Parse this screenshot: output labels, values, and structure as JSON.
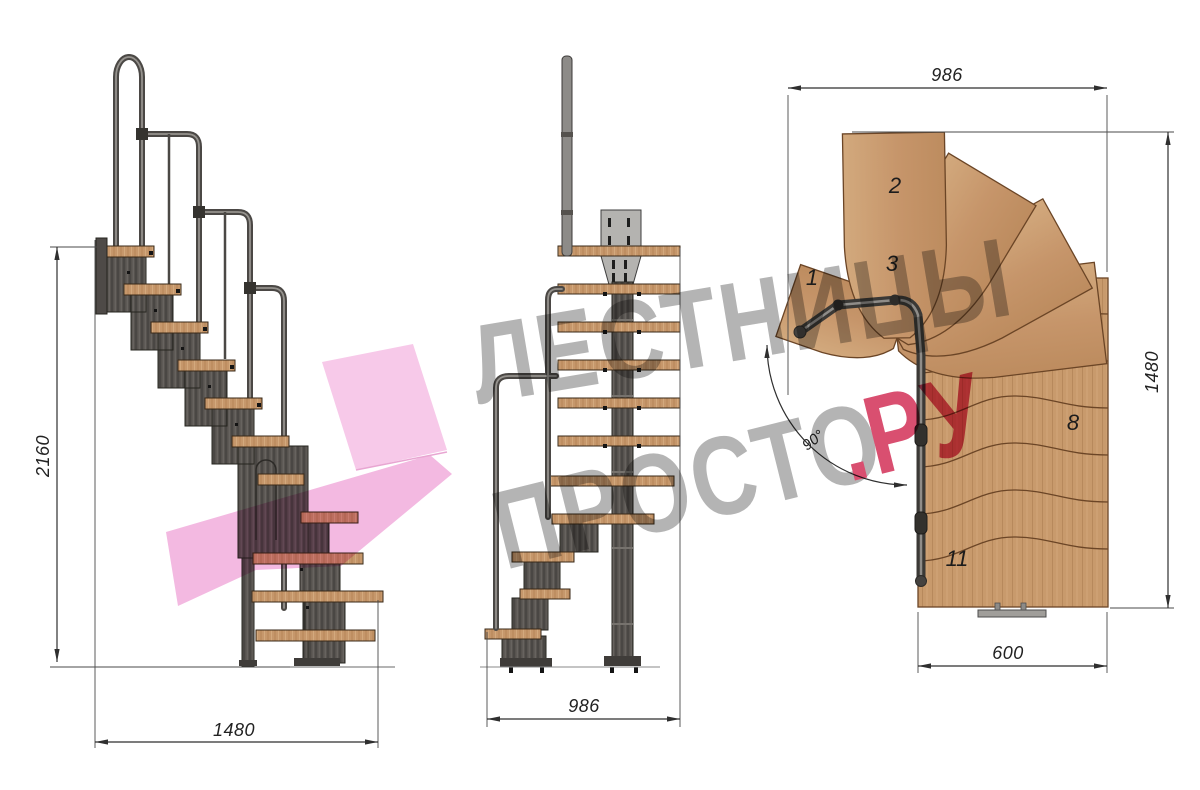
{
  "title": "modular staircase technical drawing",
  "side_view": {
    "height_label": "2160",
    "length_label": "1480"
  },
  "front_view": {
    "width_label": "986"
  },
  "plan_view": {
    "top_width_label": "986",
    "right_height_label": "1480",
    "bottom_width_label": "600",
    "angle_label": "90°",
    "step_numbers": [
      "1",
      "2",
      "3",
      "8",
      "11"
    ]
  },
  "watermark": {
    "line1": "ЛЕСТНИЦЫ",
    "line2": "ПРОСТО",
    "suffix": ".РУ"
  },
  "colors": {
    "wood": "#c6976b",
    "wood_edge": "#6b4526",
    "metal_dark": "#57534f",
    "rail_gray": "#8a8784",
    "plate_gray": "#b4b3b0",
    "dim_line": "#2f2f2f",
    "watermark_gray": "#b4b4b4",
    "watermark_pink_text": "#d94f70",
    "watermark_pink_shape": "#f5c1e4"
  }
}
